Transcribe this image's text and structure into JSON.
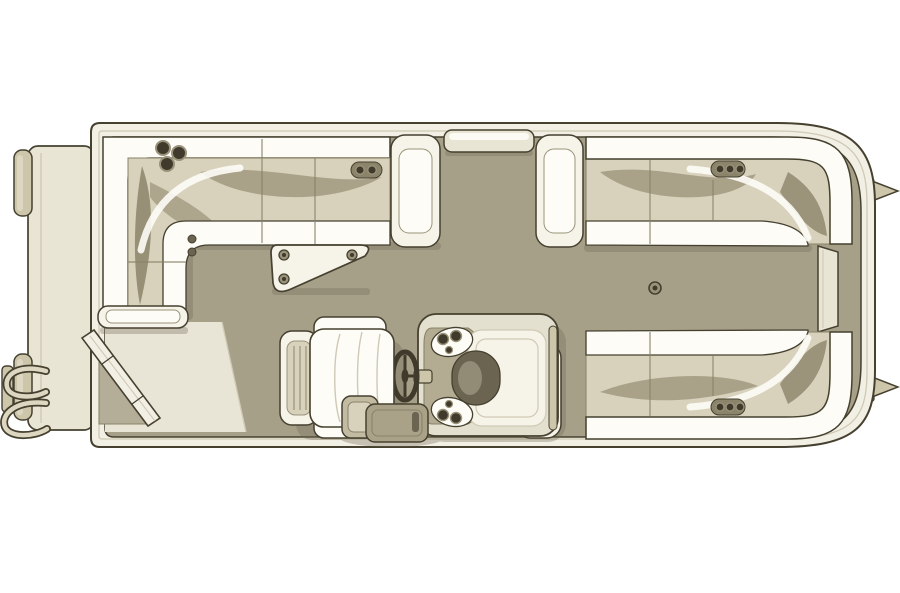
{
  "meta": {
    "diagram_type": "pontoon-boat-floor-plan",
    "view": "top-down",
    "text_content": "none"
  },
  "palette": {
    "page_bg": "#ffffff",
    "outline": "#45402f",
    "outline_soft": "#8a8368",
    "hull_rail": "#f2efe4",
    "hull_rail_line": "#cfc9b5",
    "deck_floor": "#a7a089",
    "walkway": "#e9e5d6",
    "platform": "#e9e5d5",
    "corner_step": "#b4ad97",
    "cushion_white": "#fdfcf6",
    "cushion_cream": "#f6f3e8",
    "cushion_shade": "#d8d2bd",
    "cushion_olive": "#a29a7f",
    "cushion_olive_deep": "#8c846a",
    "gate_cream": "#e9e5d4",
    "console_body": "#e4e0cf",
    "console_recess": "#b3ac93",
    "console_dark": "#6a6450",
    "fitting_dark": "#3f3a2b",
    "fitting_ring": "#9a937b",
    "metal": "#cdc6ab",
    "tube": "#ddd7c1",
    "step_pad": "#c2bba2",
    "step_dark": "#aaa288",
    "shadow": "#6e6753"
  },
  "components": [
    "swim-platform",
    "boarding-ladder",
    "pontoon-end-cap",
    "pontoon-nose-cone",
    "hull-rub-rail",
    "deck-floor",
    "stern-entry-walkway",
    "stern-diagonal-gate",
    "left-wraparound-lounge",
    "top-gate",
    "top-right-lounge",
    "bottom-right-lounge",
    "side-bow-gate",
    "corner-table",
    "cup-holders",
    "table-mount",
    "helm-console",
    "steering-wheel",
    "captains-chair",
    "entry-step-gate"
  ]
}
